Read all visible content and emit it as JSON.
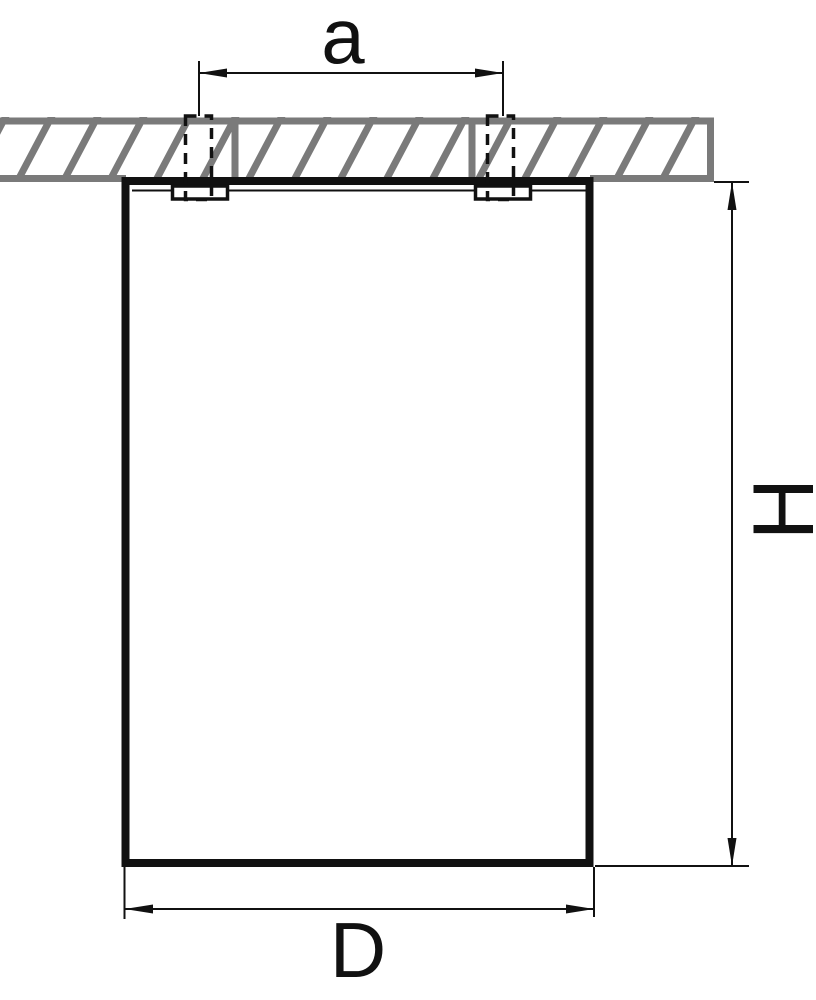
{
  "drawing": {
    "dim_top_label": "a",
    "dim_right_label": "H",
    "dim_bottom_label": "D",
    "colors": {
      "line_color": "#111111",
      "ceiling_gray": "#7a7a7a"
    }
  }
}
